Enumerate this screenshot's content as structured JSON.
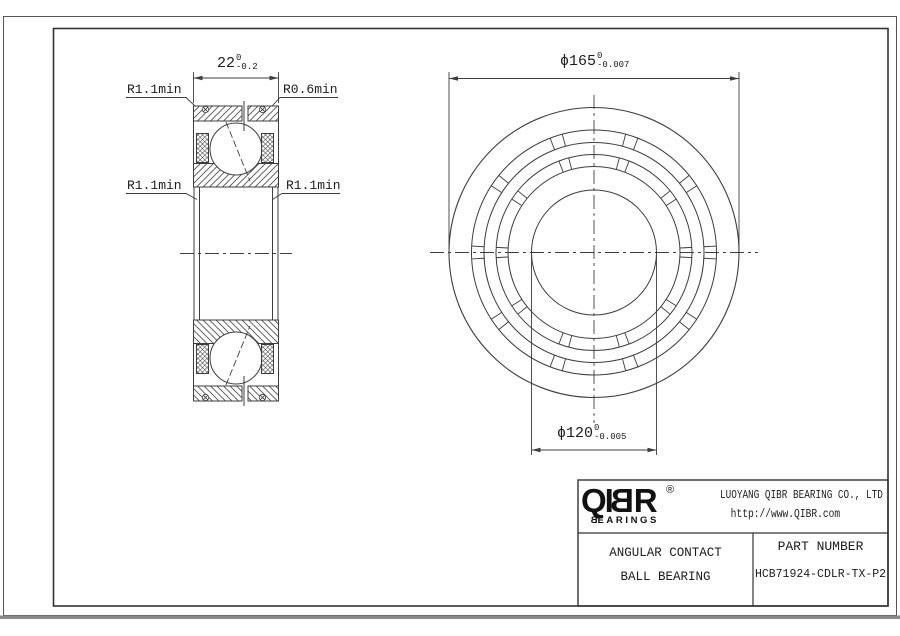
{
  "drawing": {
    "left_view": {
      "width_dim": {
        "value": "22",
        "tol_top": "0",
        "tol_bottom": "-0.2"
      },
      "labels": {
        "top_left": "R1.1min",
        "top_right": "R0.6min",
        "bottom_left": "R1.1min",
        "bottom_right": "R1.1min"
      }
    },
    "front_view": {
      "outer_dim": {
        "value": "ϕ165",
        "tol_top": "0",
        "tol_bottom": "-0.007"
      },
      "bore_dim": {
        "value": "ϕ120",
        "tol_top": "0",
        "tol_bottom": "-0.005"
      }
    }
  },
  "title_block": {
    "logo": {
      "part1": "QI",
      "mirrored_b": "B",
      "part2": "R",
      "registered": "®",
      "sub_b": "B",
      "sub_rest": "EARINGS"
    },
    "company": "LUOYANG QIBR BEARING CO., LTD",
    "website": "http://www.QIBR.com",
    "product_line1": "ANGULAR CONTACT",
    "product_line2": "BALL BEARING",
    "part_number_label": "PART NUMBER",
    "part_number": "HCB71924-CDLR-TX-P2"
  },
  "colors": {
    "line_color": "#3d3d3d",
    "hatch_color": "#4a4a4a",
    "sheet_edge_color": "#8a8a8a",
    "text_color": "#1d1d1d"
  }
}
